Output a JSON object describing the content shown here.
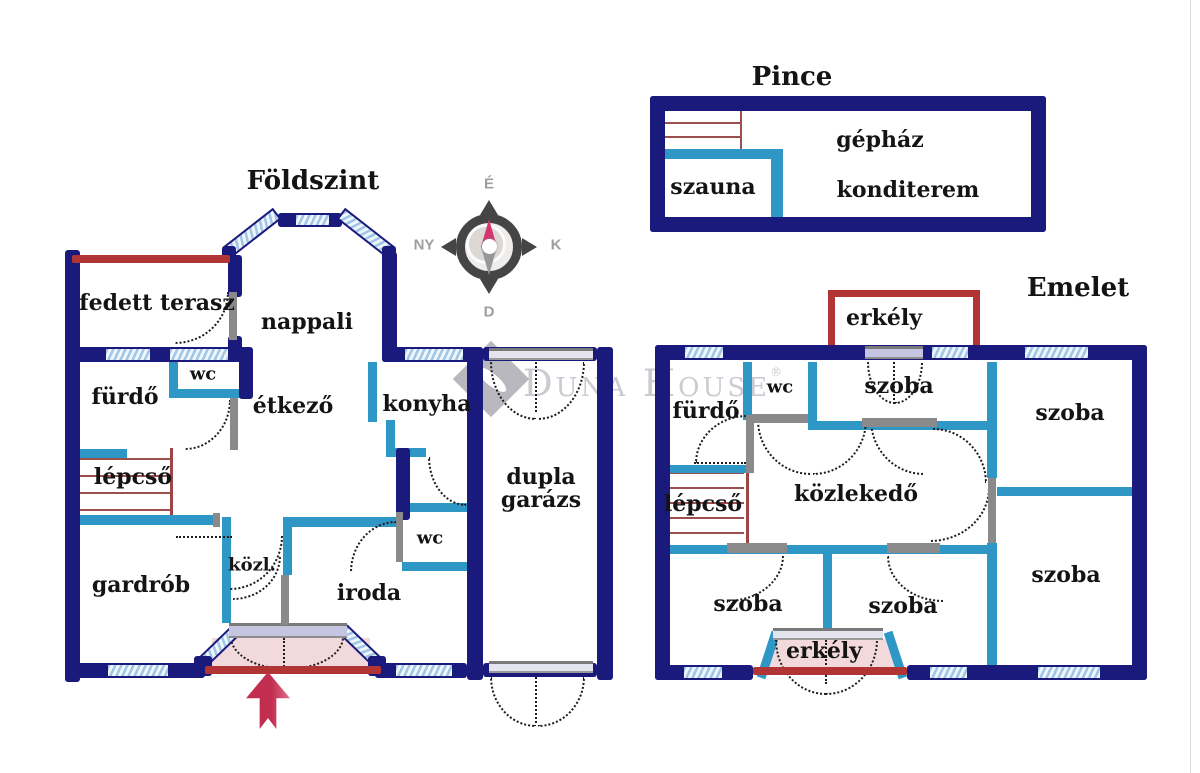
{
  "titles": {
    "ground": "Földszint",
    "basement": "Pince",
    "upper": "Emelet"
  },
  "compass": {
    "north": "É",
    "west": "NY",
    "east": "K",
    "south": "D"
  },
  "watermark": {
    "text": "Duna House",
    "registered": "®"
  },
  "ground": {
    "terrace": "fedett terasz",
    "living": "nappali",
    "wc_top": "wc",
    "bath": "fürdő",
    "dining": "étkező",
    "kitchen": "konyha",
    "stairs": "lépcső",
    "wardrobe": "gardrób",
    "hallway": "közl.",
    "office": "iroda",
    "wc_bottom": "wc",
    "garage": "dupla garázs"
  },
  "basement": {
    "sauna": "szauna",
    "plant_room": "gépház",
    "gym": "konditerem"
  },
  "upper": {
    "balcony_top": "erkély",
    "bath": "fürdő",
    "wc": "wc",
    "room_top": "szoba",
    "room_top_right": "szoba",
    "stairs": "lépcső",
    "hallway": "közlekedő",
    "room_bottom_left": "szoba",
    "room_bottom_mid": "szoba",
    "room_bottom_right": "szoba",
    "balcony_bottom": "erkély"
  },
  "colors": {
    "outer_wall": "#1a1a7d",
    "inner_wall": "#2e97c5",
    "accent_red": "#b23535",
    "stair_red": "#9c4f4f",
    "arrow_red": "#c22e50",
    "window_blue": "#a8cbe8"
  }
}
